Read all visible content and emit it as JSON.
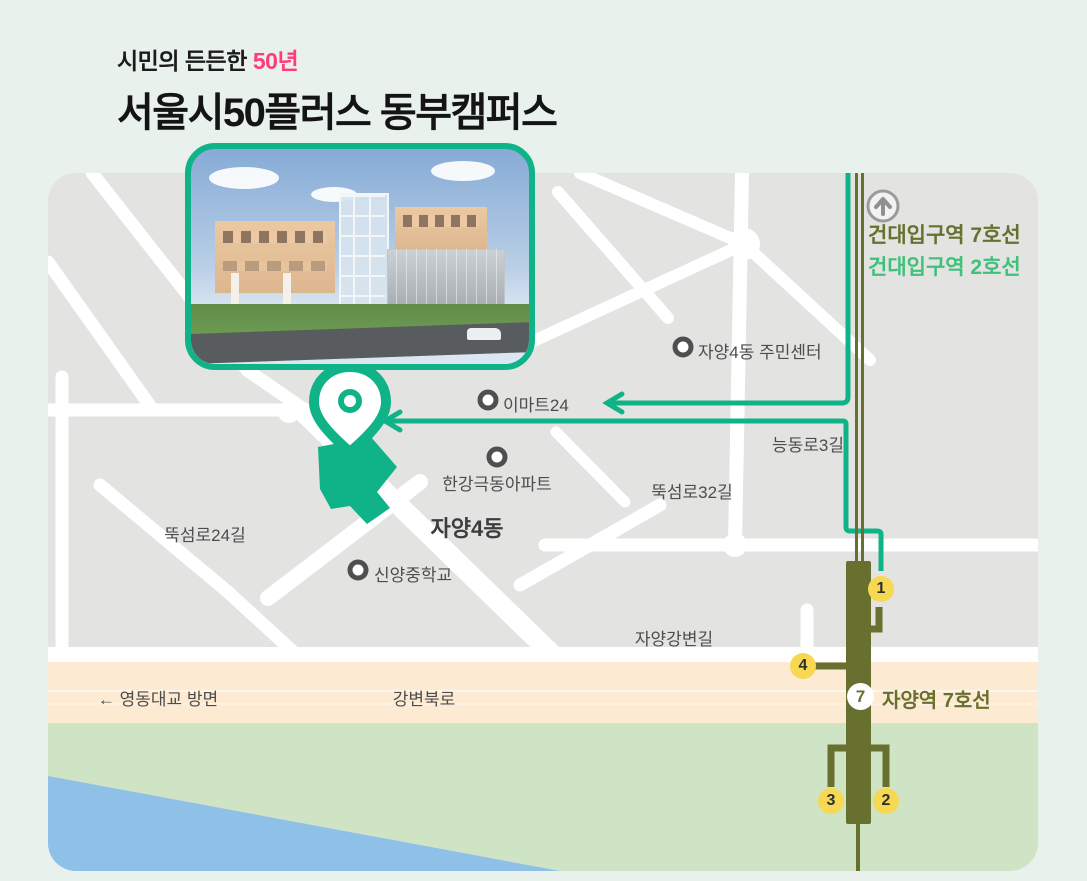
{
  "colors": {
    "pagebg": "#e9f1ed",
    "panel": "#e3e3e2",
    "accent": "#10b287",
    "line7": "#68702f",
    "line2": "#3fc17c",
    "yellow": "#f7d853",
    "pink": "#ff3c78",
    "beige": "#fcead2",
    "park": "#cfe3c5",
    "river": "#8fc0e8",
    "labelgray": "#4d4d4d",
    "ring": "#4f4f4f",
    "badgetext": "#2e2e2e"
  },
  "header": {
    "tagline_prefix": "시민의 든든한",
    "tagline_highlight": "50년",
    "title": "서울시50플러스 동부캠퍼스"
  },
  "map": {
    "district": "자양4동",
    "poi": [
      {
        "label": "자양4동 주민센터"
      },
      {
        "label": "이마트24"
      },
      {
        "label": "한강극동아파트"
      },
      {
        "label": "신양중학교"
      }
    ],
    "road_labels": [
      {
        "label": "능동로3길"
      },
      {
        "label": "뚝섬로32길"
      },
      {
        "label": "뚝섬로24길"
      },
      {
        "label": "자양강변길"
      },
      {
        "label": "강변북로"
      },
      {
        "label": "← 영동대교 방면"
      }
    ],
    "stations": {
      "jayang_badge": "7",
      "jayang": "자양역 7호선",
      "kondae_line7": "건대입구역 7호선",
      "kondae_line2": "건대입구역 2호선"
    },
    "exits": {
      "e1": "1",
      "e2": "2",
      "e3": "3",
      "e4": "4"
    }
  }
}
